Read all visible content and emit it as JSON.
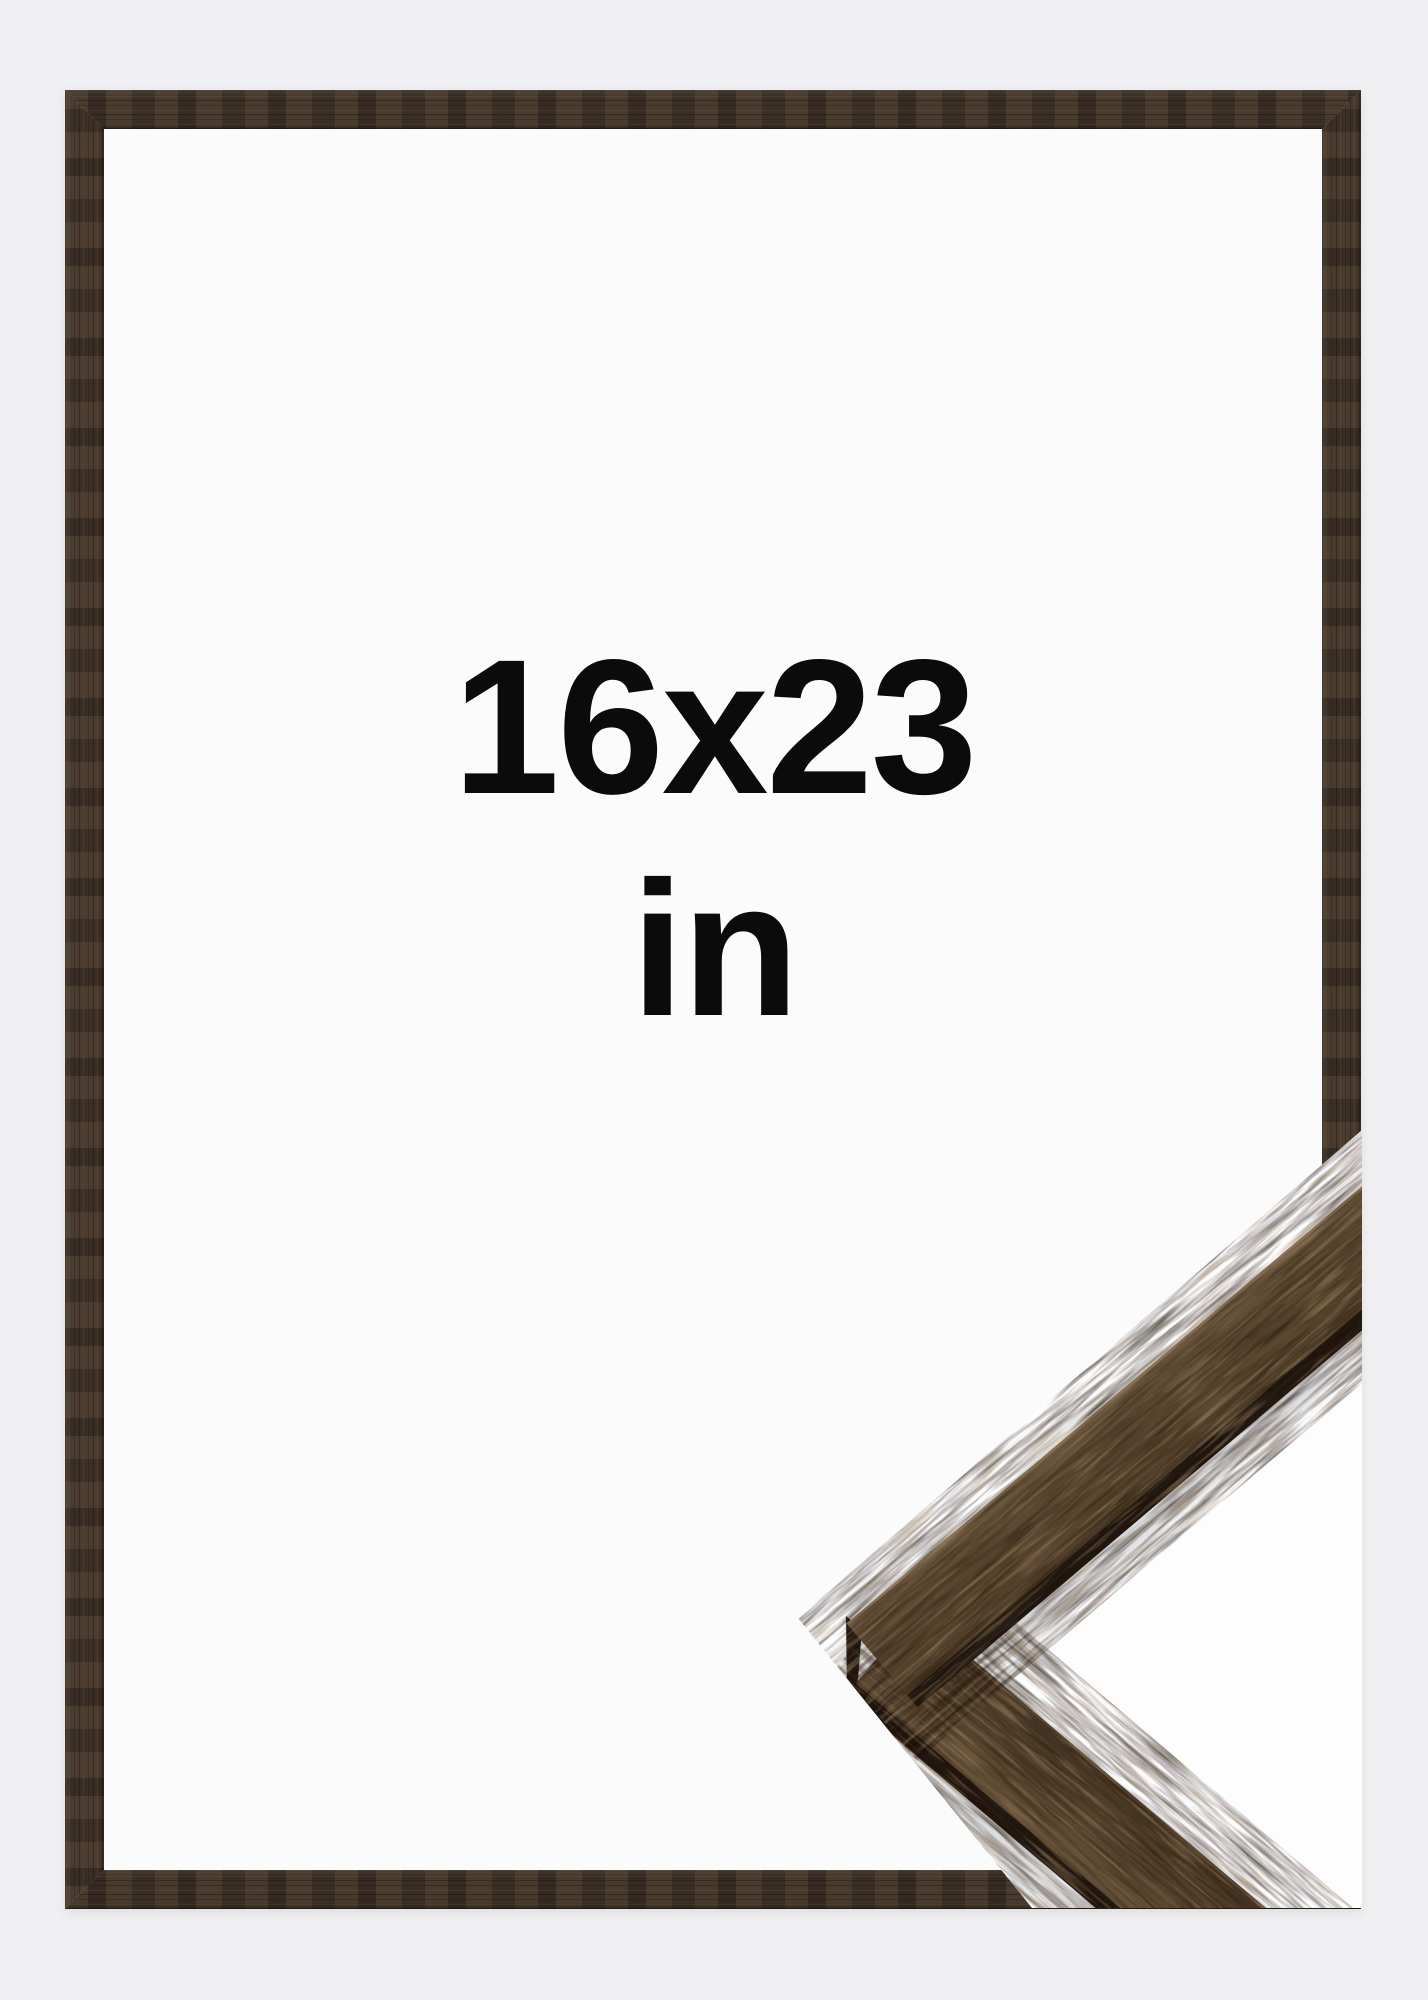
{
  "page": {
    "background_color": "#f0f0f2",
    "description_colors": {
      "frame_wood_base": "#40342a",
      "sample_wood_base": "#5a4733",
      "sample_wood_edge": "#221a11",
      "frame_opening": "#fbfbfc",
      "sample_backdrop": "#fdfdfe",
      "text": "#0b0b0b"
    }
  },
  "product_image": {
    "size_label": "16x23",
    "unit_label": "in"
  }
}
